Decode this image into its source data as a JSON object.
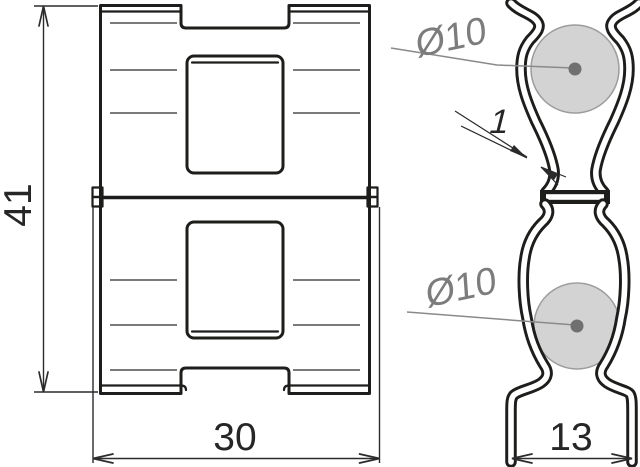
{
  "drawing": {
    "kind": "two-view technical drawing of a sheet-steel spring clip conductor holder",
    "front_view": {
      "name": "front elevation"
    },
    "side_view": {
      "name": "side profile"
    },
    "dimensions": {
      "height": {
        "label": "41"
      },
      "width": {
        "label": "30"
      },
      "base_width": {
        "label": "13"
      },
      "material_thickness": {
        "label": "1"
      }
    },
    "callouts": {
      "rod_top": {
        "label": "Ø10"
      },
      "rod_bottom": {
        "label": "Ø10"
      }
    },
    "colors": {
      "line": "#1d1d1b",
      "thin_line": "#2b2b2b",
      "dim_text": "#262626",
      "gray_text": "#7c7c7c",
      "leader": "#8a8a8a",
      "rod_fill": "#d3d3d3",
      "rod_outline": "#9c9c9c",
      "rod_dot": "#707070",
      "background": "#ffffff"
    }
  }
}
